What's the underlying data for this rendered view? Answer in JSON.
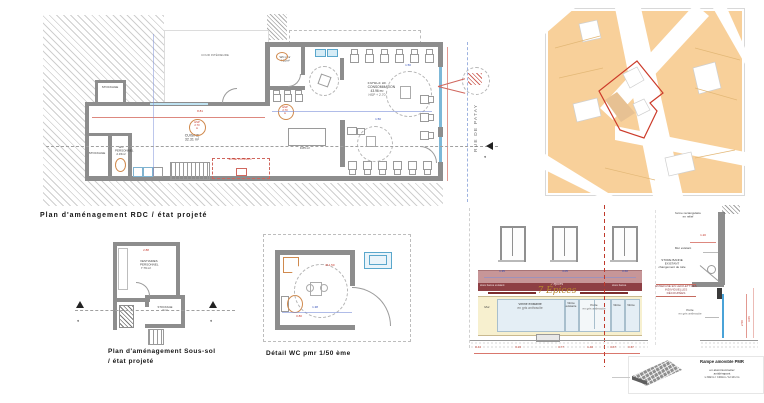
{
  "titles": {
    "rdc": "Plan  d'aménagement RDC / état projeté",
    "soussol_1": "Plan  d'aménagement Sous-sol",
    "soussol_2": "/ état projeté",
    "wc": "Détail WC pmr 1/50 ème"
  },
  "rdc": {
    "cour": "COUR INTÉRIEURE",
    "rue": "RUE DE PATAY",
    "section_letter": "A",
    "hsp": "HSP 2.70 m",
    "zone_cuisson": "ZONE CUISSON",
    "dim_881": "8.81",
    "dim_150": "1.50",
    "rooms": {
      "stockage_top": {
        "name": "STOCKAGE"
      },
      "stockage_left": {
        "name": "STOCKAGE"
      },
      "wc_personnel": {
        "name": "WC PERSONNEL",
        "area": "2.15m²"
      },
      "cuisine": {
        "name": "CUISINE",
        "area": "32.31 m²"
      },
      "wc_pmr": {
        "name": "WC pmr",
        "area": "4.20m²"
      },
      "espace": {
        "name": "ESPACE DE CONSOMMATION",
        "area": "43.96 m²",
        "sub": "HSP + 2.70"
      },
      "arriere": {
        "name": "ARRIÈRE COMPTOIR",
        "area": "9.85 m²"
      }
    }
  },
  "soussol": {
    "vestiaires_name": "VESTIAIRES PERSONNEL",
    "vestiaires_area": "7.79 m²",
    "stockage_name": "STOCKAGE",
    "stockage_area": "3 m²",
    "dim_288": "2.88",
    "section_letter": "A"
  },
  "wc_detail": {
    "dim_circle": "Ø 1.50",
    "dim_w": "1.38",
    "dim_h": "0.80"
  },
  "elevation": {
    "band_left": "store banne existant",
    "band_center": "7 épices",
    "band_right": "store banne",
    "sign": "7 Épices",
    "panels": {
      "mur": "Mur",
      "v1": "Vitrine existante",
      "v2": "Vitrine existante",
      "porte": "Porte",
      "v3": "Vitrine",
      "v4": "Vitrine",
      "sub": "en gris anthracite"
    },
    "dims_band": {
      "d1": "1.35",
      "d2": "3.05",
      "d3": "0.60"
    },
    "dims_bottom": [
      "0.44",
      "3.23",
      "0.77",
      "1.40",
      "0.67",
      "0.67"
    ],
    "dims_right": {
      "d1": "1.20",
      "d2": "3.06",
      "d3": "2.50"
    },
    "ann": {
      "a1_1": "forme rectangulaire",
      "a1_2": "en relief",
      "a2": "Mur existant",
      "a3_1": "STORE BANNE",
      "a3_2": "EXISTANT",
      "a3_3": "changement de toile",
      "a4_1": "ENSEIGNE EN LED/LETTRES",
      "a4_2": "INDIVIDUELLES DÉCOUPÉES",
      "a5_1": "Porte",
      "a5_2": "en gris anthracite"
    },
    "ramp": {
      "l1": "Rampe amovible PMR",
      "l2": "en aluminium/acier antidérapant",
      "l3": "L:90cm / l:40cm / H:10 cm"
    }
  }
}
